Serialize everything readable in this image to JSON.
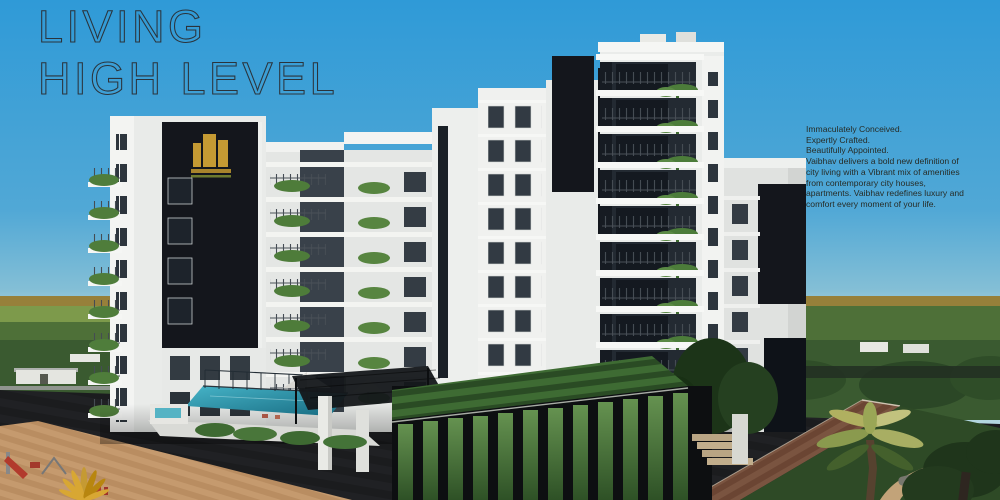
{
  "hero": {
    "title_line1": "LIVING",
    "title_line2": "HIGH LEVEL",
    "description": "Immaculately Conceived.\nExpertly Crafted.\nBeautifully Appointed.\nVaibhav delivers a bold new definition of\ncity living with a Vibrant mix of amenities\nfrom contemporary city houses,\napartments. Vaibhav redefines luxury and\ncomfort every moment of your life."
  },
  "icons": {
    "builder_logo": "stepped-building-gold-emblem",
    "pool_umbrella": "white-canopy-umbrella",
    "gold_palm": "golden-palm-frond-ornament"
  },
  "theme": {
    "title_color": "#2b333b",
    "text_dark": "#272c26",
    "sky_top": "#2f9ad7",
    "sky_horizon": "#aed4de",
    "facade_white": "#eceeec",
    "panel_black": "#14161c",
    "accent_gold": "#c59a33",
    "pool_teal": "#2a9ab2",
    "foliage_green": "#4f7d3b",
    "plaza_dark": "#1b1c1e",
    "walkway_tan": "#c59a6e"
  }
}
